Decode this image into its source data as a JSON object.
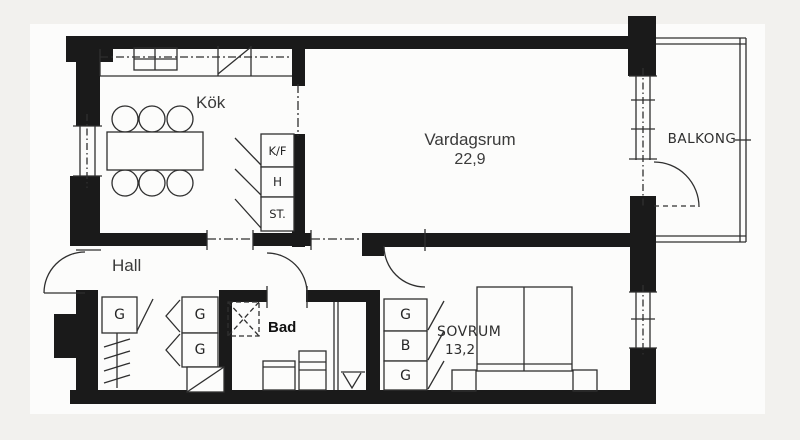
{
  "title": "apartment-floor-plan",
  "rooms": {
    "kitchen": {
      "label": "Kök"
    },
    "living": {
      "label": "Vardagsrum",
      "area": "22,9"
    },
    "balcony": {
      "label": "BALKONG"
    },
    "hall": {
      "label": "Hall"
    },
    "bathroom": {
      "label": "Bad"
    },
    "bedroom": {
      "label": "SOVRUM",
      "area": "13,2"
    }
  },
  "fixtures": {
    "fridge_freezer": "K/F",
    "shelf": "H",
    "cleaning_closet": "ST.",
    "hall_wardrobe_left": "G",
    "hall_wardrobe_mid_1": "G",
    "hall_wardrobe_mid_2": "G",
    "bedroom_wardrobe_1": "G",
    "bedroom_linen": "B",
    "bedroom_wardrobe_2": "G"
  },
  "colors": {
    "wall": "#1a1a1a",
    "line": "#2f2f2f",
    "paper": "#fcfcfb",
    "background": "#f2f1ee"
  }
}
